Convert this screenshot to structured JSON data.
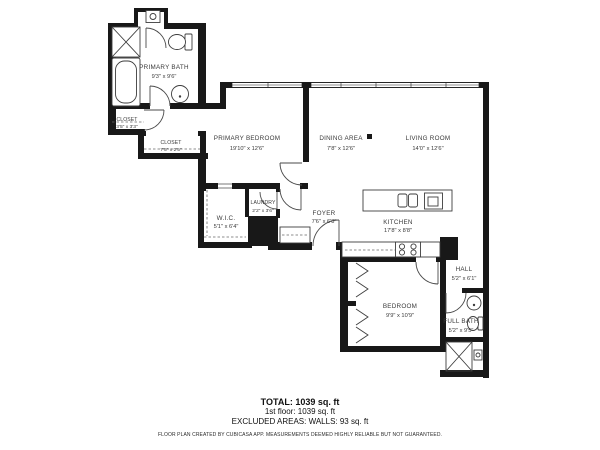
{
  "colors": {
    "wall": "#181818",
    "fixture": "#3d3d3d",
    "text": "#3a3a3a",
    "background": "#ffffff"
  },
  "rooms": [
    {
      "id": "primary-bath",
      "name": "PRIMARY BATH",
      "dims": "9'3\" x 9'6\""
    },
    {
      "id": "closet-small",
      "name": "CLOSET",
      "dims": "3'5\" x 3'3\""
    },
    {
      "id": "closet-long",
      "name": "CLOSET",
      "dims": "7'5\" x 2'5\""
    },
    {
      "id": "primary-bedroom",
      "name": "PRIMARY BEDROOM",
      "dims": "19'10\" x 12'6\""
    },
    {
      "id": "dining-area",
      "name": "DINING AREA",
      "dims": "7'8\" x 12'6\""
    },
    {
      "id": "living-room",
      "name": "LIVING ROOM",
      "dims": "14'0\" x 12'6\""
    },
    {
      "id": "wic",
      "name": "W.I.C.",
      "dims": "5'1\" x 6'4\""
    },
    {
      "id": "laundry",
      "name": "LAUNDRY",
      "dims": "2'2\" x 3'6\""
    },
    {
      "id": "foyer",
      "name": "FOYER",
      "dims": "7'6\" x 6'8\""
    },
    {
      "id": "kitchen",
      "name": "KITCHEN",
      "dims": "17'8\" x 8'8\""
    },
    {
      "id": "hall",
      "name": "HALL",
      "dims": "5'2\" x 6'1\""
    },
    {
      "id": "bedroom",
      "name": "BEDROOM",
      "dims": "9'9\" x 10'9\""
    },
    {
      "id": "full-bath",
      "name": "FULL BATH",
      "dims": "5'2\" x 9'5\""
    }
  ],
  "summary": {
    "total": "TOTAL: 1039 sq. ft",
    "first_floor": "1st floor: 1039 sq. ft",
    "excluded": "EXCLUDED AREAS: WALLS: 93 sq. ft",
    "disclaimer": "FLOOR PLAN CREATED BY CUBICASA APP. MEASUREMENTS DEEMED HIGHLY RELIABLE BUT NOT GUARANTEED."
  },
  "icons": [
    "shower-icon",
    "bathtub-icon",
    "toilet-icon",
    "sink-icon",
    "water-heater-icon",
    "island-sink-icon",
    "cooktop-icon",
    "stove-icon",
    "closet-rod-dashes",
    "door-arc",
    "window-band",
    "shaft-cross",
    "folding-door-chevrons"
  ]
}
